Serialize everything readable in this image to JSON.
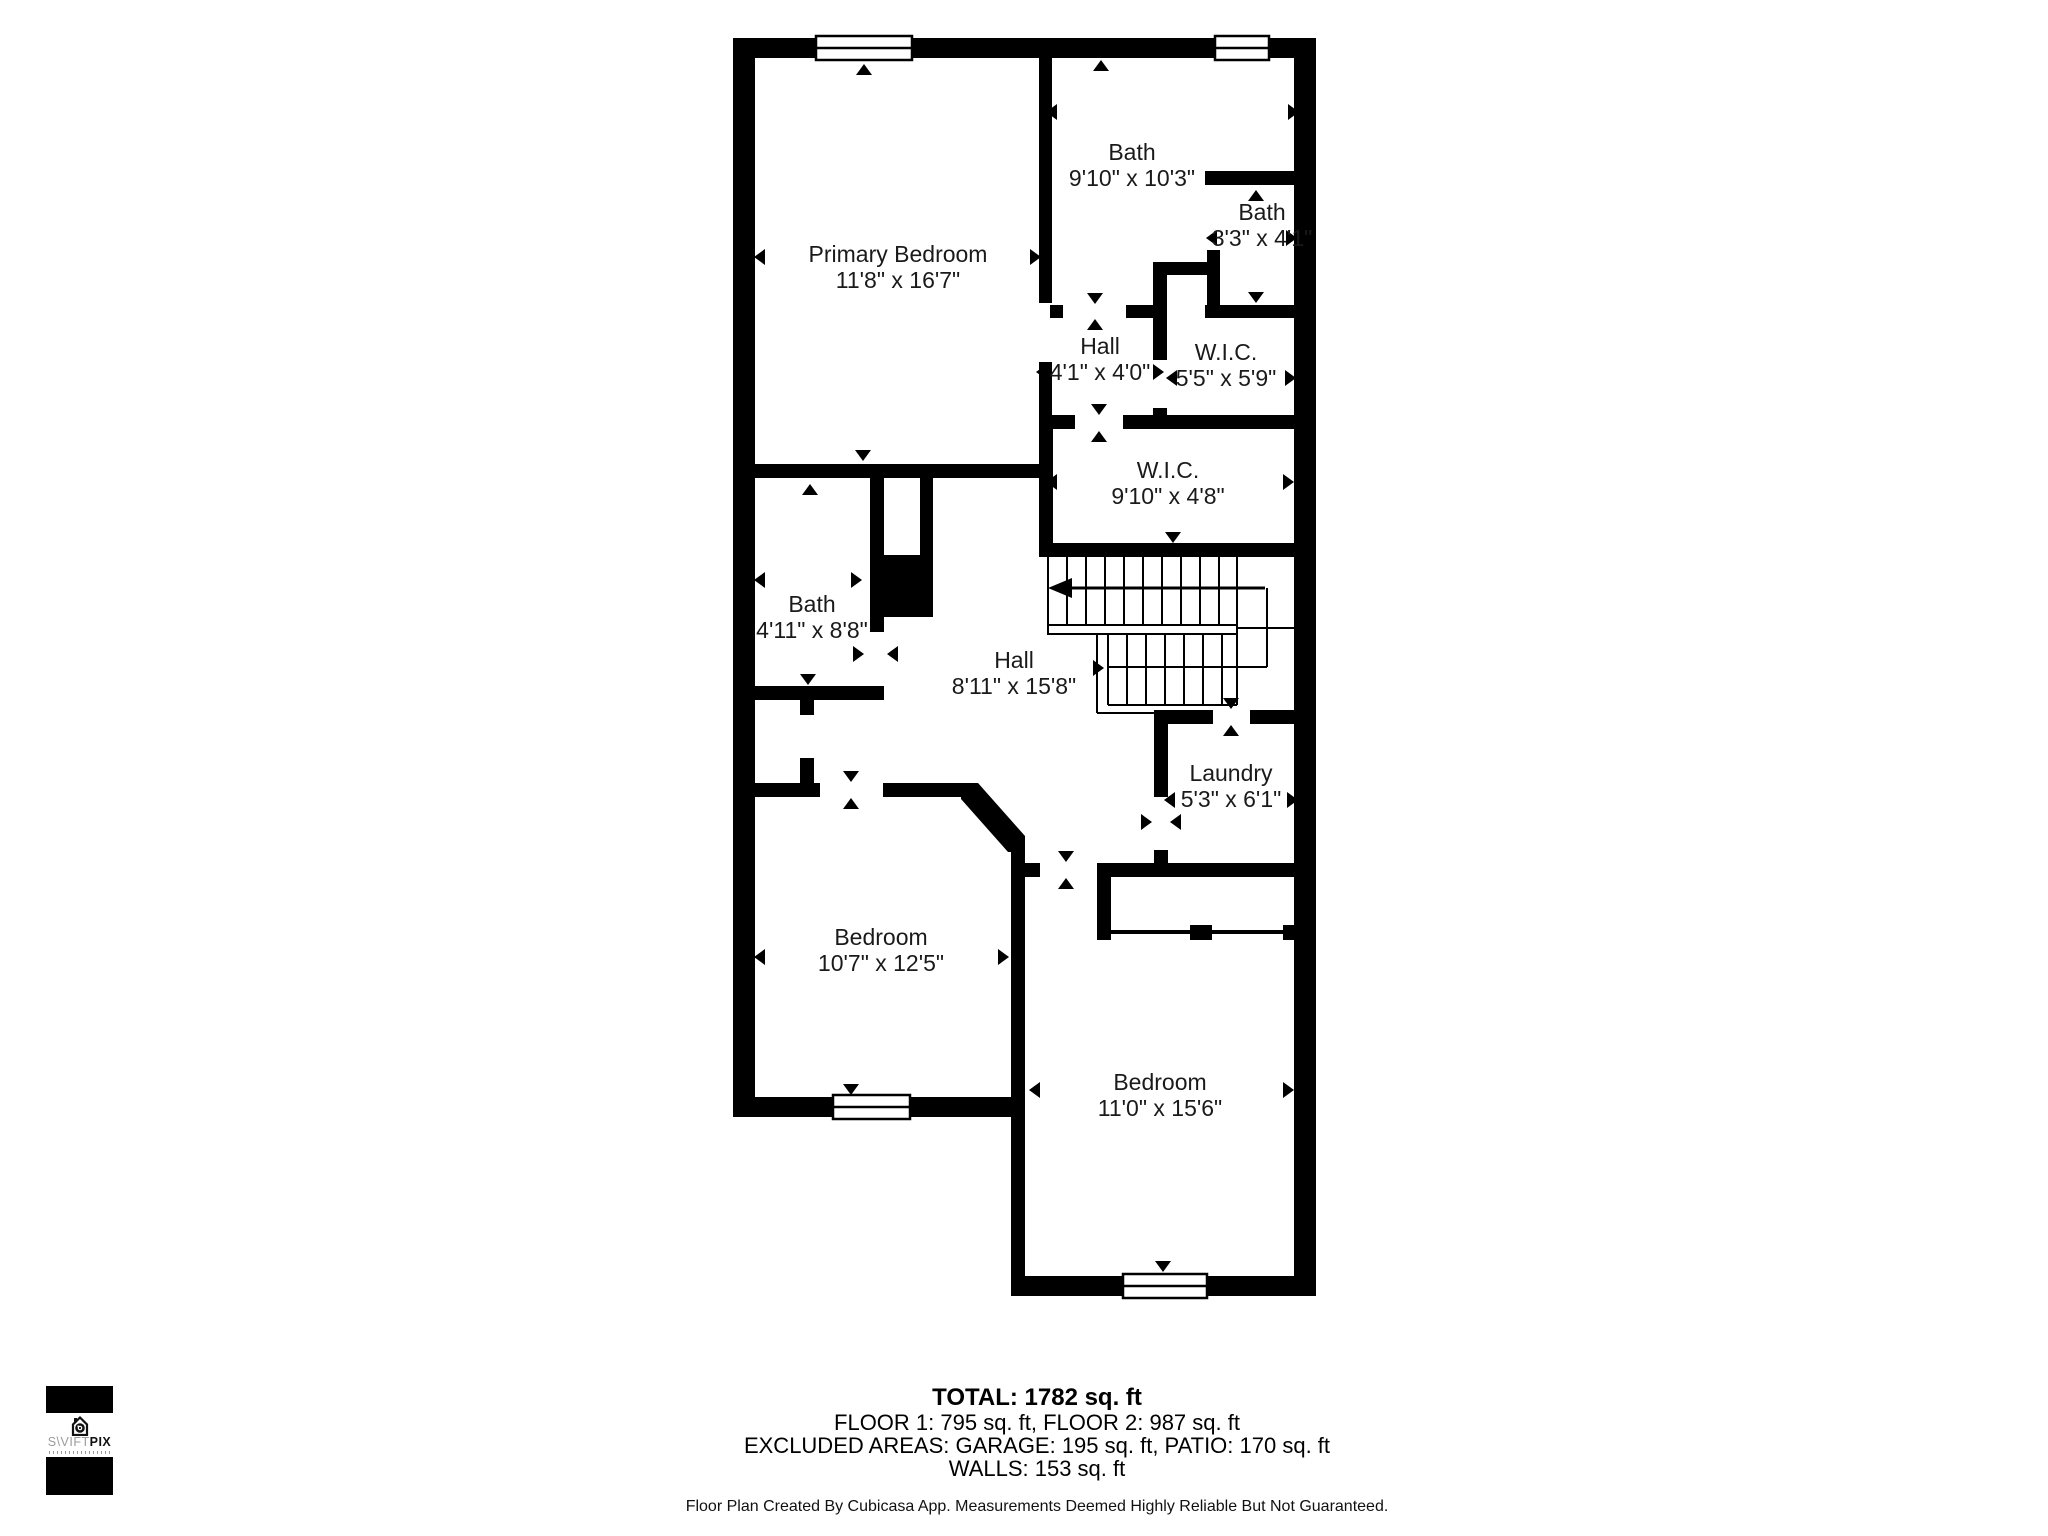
{
  "floor_plan": {
    "rooms": [
      {
        "name": "Primary Bedroom",
        "dims": "11'8\" x 16'7\""
      },
      {
        "name": "Bath",
        "dims": "9'10\" x 10'3\""
      },
      {
        "name": "Bath",
        "dims": "3'3\" x 4'1\""
      },
      {
        "name": "Hall",
        "dims": "4'1\" x 4'0\""
      },
      {
        "name": "W.I.C.",
        "dims": "5'5\" x 5'9\""
      },
      {
        "name": "W.I.C.",
        "dims": "9'10\" x 4'8\""
      },
      {
        "name": "Bath",
        "dims": "4'11\" x 8'8\""
      },
      {
        "name": "Hall",
        "dims": "8'11\" x 15'8\""
      },
      {
        "name": "Laundry",
        "dims": "5'3\" x 6'1\""
      },
      {
        "name": "Bedroom",
        "dims": "10'7\" x 12'5\""
      },
      {
        "name": "Bedroom",
        "dims": "11'0\" x 15'6\""
      }
    ],
    "features": [
      "stairs",
      "windows",
      "door-openings"
    ]
  },
  "footer": {
    "total": "TOTAL: 1782 sq. ft",
    "floors": "FLOOR 1: 795 sq. ft, FLOOR 2: 987 sq. ft",
    "excluded": "EXCLUDED AREAS: GARAGE: 195 sq. ft, PATIO: 170 sq. ft",
    "walls": "WALLS: 153 sq. ft",
    "disclaimer": "Floor Plan Created By Cubicasa App. Measurements Deemed Highly Reliable But Not Guaranteed."
  },
  "logo": {
    "brand_light": "S\\VIFT",
    "brand_bold": "PIX"
  },
  "colors": {
    "wall": "#000000",
    "background": "#ffffff",
    "label_text": "#1a1a1a"
  }
}
